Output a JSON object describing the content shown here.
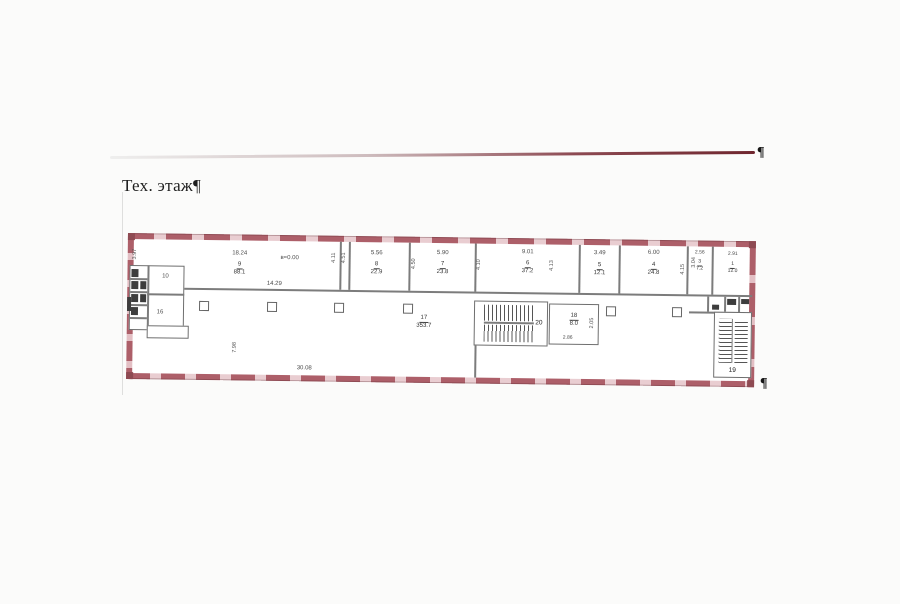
{
  "page": {
    "title": "Тех. этаж¶",
    "pilcrow": "¶"
  },
  "plan": {
    "elevation": "в=0.00",
    "dims": {
      "corridor": "14.29",
      "left_height": "3.97",
      "hall_height": "7.98",
      "bottom_width": "30.08"
    },
    "top_rooms": [
      {
        "num": "9",
        "area": "88.1",
        "width": "18.24"
      },
      {
        "num": "8",
        "area": "22.9",
        "width": "5.56"
      },
      {
        "num": "7",
        "area": "23.8",
        "width": "5.90"
      },
      {
        "num": "6",
        "area": "37.2",
        "width": "9.01"
      },
      {
        "num": "5",
        "area": "12.1",
        "width": "3.49"
      },
      {
        "num": "4",
        "area": "24.8",
        "width": "6.00"
      },
      {
        "num": "3",
        "area": "7.2",
        "width": "2.56"
      },
      {
        "num": "1",
        "area": "12.0",
        "width": "2.91"
      }
    ],
    "side_dims": [
      "4.11",
      "4.51",
      "4.50",
      "4.10",
      "4.13",
      "4.15",
      "3.04"
    ],
    "hall": {
      "num": "17",
      "area": "353.7"
    },
    "room18": {
      "num": "18",
      "area": "8.0",
      "width": "2.86",
      "depth": "2.05"
    },
    "stairs": {
      "main": "20",
      "right": "19"
    },
    "core": {
      "room_a": "10",
      "room_b": "16"
    }
  }
}
